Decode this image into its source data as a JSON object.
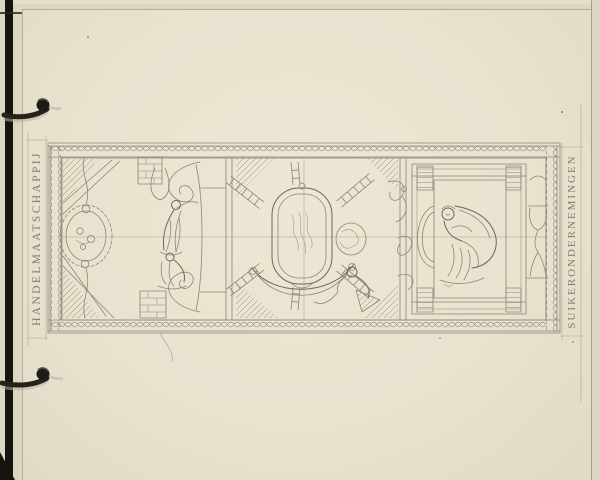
{
  "artwork": {
    "left_margin_text": "HANDELMAATSCHAPPIJ",
    "right_margin_text": "SUIKERONDERNEMINGEN"
  },
  "icons": {
    "binder_ring_top": "binder-ring",
    "binder_ring_bottom": "binder-ring"
  },
  "colors": {
    "paper": "#e9e2cf",
    "paper_edge": "#ddd6c2",
    "paper_strip": "#e4ddca",
    "pencil": "#8d8577",
    "pencil_dark": "#6d665a",
    "pencil_faint": "#aaa28c",
    "edge_dark": "#16140e",
    "ring_metal": "#25221c"
  }
}
